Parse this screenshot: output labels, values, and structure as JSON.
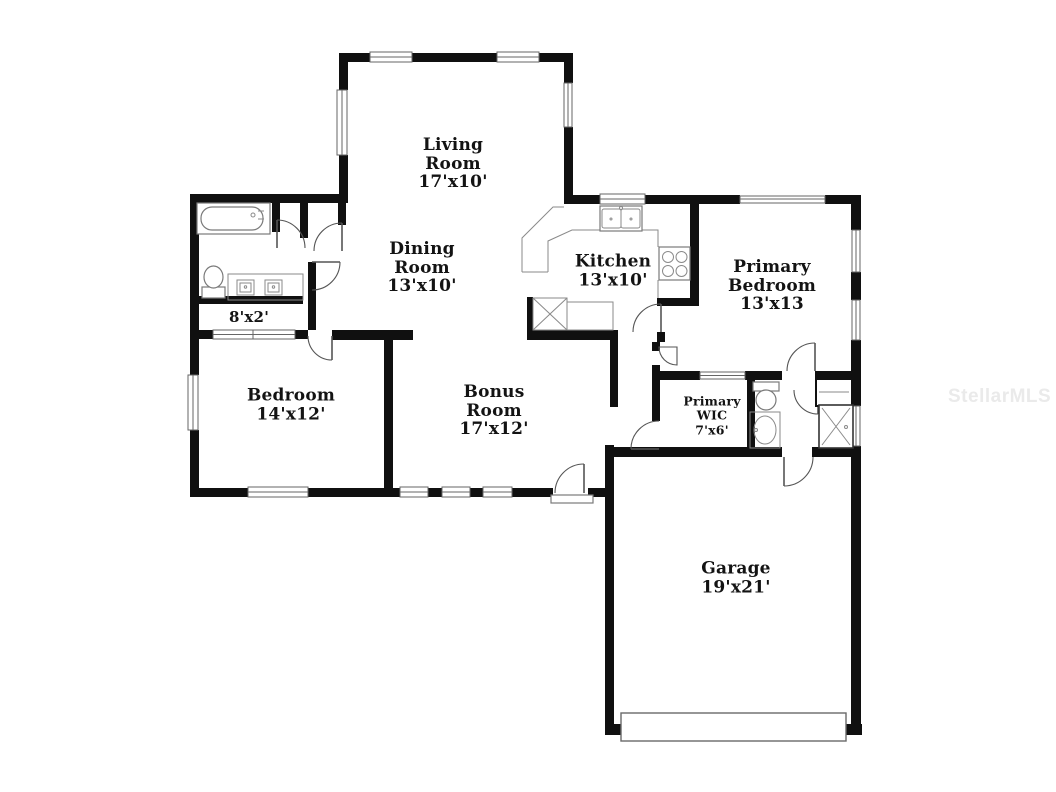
{
  "watermark": "StellarMLS",
  "rooms": {
    "living": {
      "name": "Living Room",
      "dims": "17'x10'"
    },
    "dining": {
      "name": "Dining Room",
      "dims": "13'x10'"
    },
    "kitchen": {
      "name": "Kitchen",
      "dims": "13'x10'"
    },
    "primary": {
      "name": "Primary Bedroom",
      "dims": "13'x13"
    },
    "hall": {
      "dims": "8'x2'"
    },
    "bedroom": {
      "name": "Bedroom",
      "dims": "14'x12'"
    },
    "bonus": {
      "name": "Bonus Room",
      "dims": "17'x12'"
    },
    "wic": {
      "name": "Primary WIC",
      "dims": "7'x6'"
    },
    "garage": {
      "name": "Garage",
      "dims": "19'x21'"
    }
  },
  "colors": {
    "wall": "#101010",
    "fixture_line": "#7a7a7a",
    "label_text": "#131313",
    "watermark_text": "#eaeaea",
    "background": "#ffffff"
  }
}
